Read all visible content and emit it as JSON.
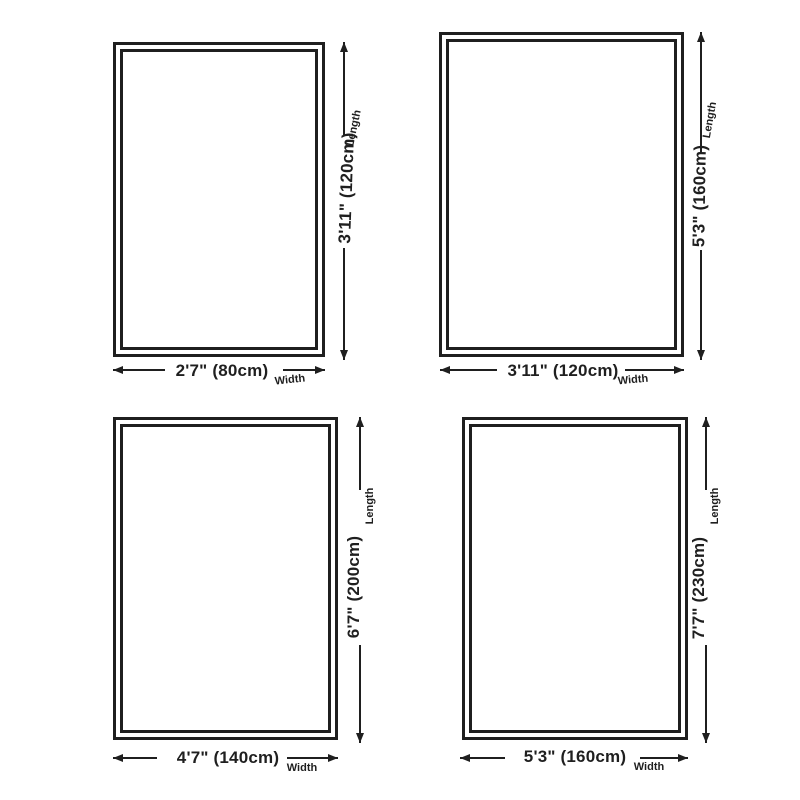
{
  "page": {
    "background": "#ffffff",
    "ink": "#1f1f1f"
  },
  "labels": {
    "length": "Length",
    "width": "Width"
  },
  "panels": [
    {
      "position": "top-left",
      "width_text": "2'7\" (80cm)",
      "length_text": "3'11\" (120cm)",
      "width_cm": 80,
      "length_cm": 120
    },
    {
      "position": "top-right",
      "width_text": "3'11\" (120cm)",
      "length_text": "5'3\" (160cm)",
      "width_cm": 120,
      "length_cm": 160
    },
    {
      "position": "bottom-left",
      "width_text": "4'7\" (140cm)",
      "length_text": "6'7\" (200cm)",
      "width_cm": 140,
      "length_cm": 200
    },
    {
      "position": "bottom-right",
      "width_text": "5'3\" (160cm)",
      "length_text": "7'7\" (230cm)",
      "width_cm": 160,
      "length_cm": 230
    }
  ]
}
